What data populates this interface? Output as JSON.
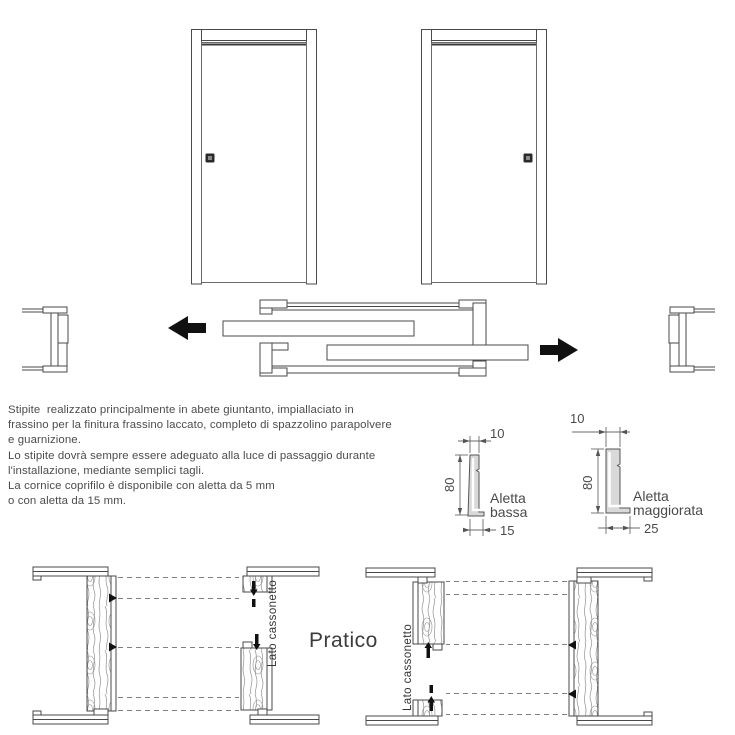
{
  "page": {
    "background": "#ffffff",
    "line_color": "#4a4a4a",
    "black": "#111111",
    "wood_grain_color": "#909090",
    "profile_fill": "#d9d9d9"
  },
  "icons": {
    "arrow_left_icon": "◀",
    "arrow_right_icon": "▶",
    "door_handle_icon": "▪"
  },
  "description": {
    "lines": [
      "Stipite  realizzato principalmente in abete giuntanto, impiallaciato in",
      "frassino per la finitura frassino laccato, completo di spazzolino parapolvere",
      "e guarnizione.",
      "Lo stipite dovrà sempre essere adeguato alla luce di passaggio durante",
      "l'installazione, mediante semplici tagli.",
      "La cornice coprifilo è disponibile con aletta da 5 mm",
      "o con aletta da 15 mm."
    ]
  },
  "profiles": {
    "aletta_bassa": {
      "width_top": "10",
      "height": "80",
      "width_bottom": "15",
      "label_line1": "Aletta",
      "label_line2": "bassa"
    },
    "aletta_maggiorata": {
      "width_top": "10",
      "height": "80",
      "width_bottom": "25",
      "label_line1": "Aletta",
      "label_line2": "maggiorata"
    }
  },
  "sections": {
    "left_detail_label": "Lato cassonetto",
    "right_detail_label": "Lato cassonetto",
    "series_name": "Pratico"
  }
}
